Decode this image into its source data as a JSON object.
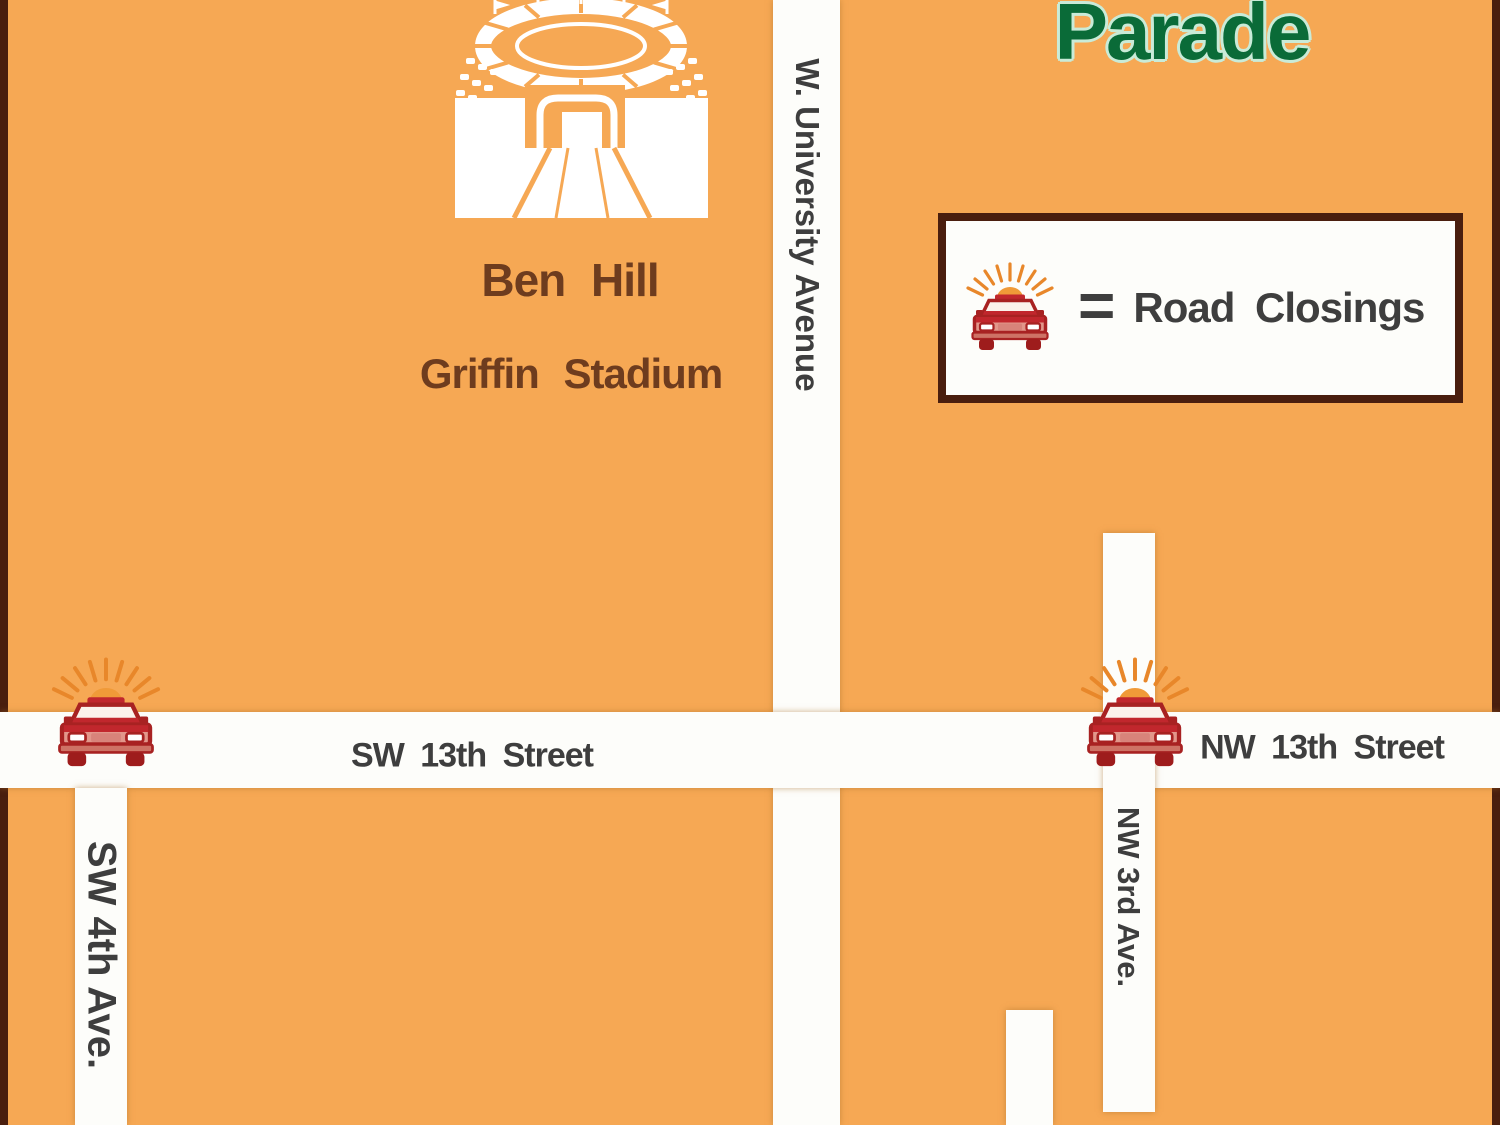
{
  "title": {
    "text": "Parade"
  },
  "stadium": {
    "label_line1": "Ben Hill",
    "label_line2": "Griffin Stadium"
  },
  "legend": {
    "icon": "police-car-icon",
    "equals": "=",
    "label": "Road Closings"
  },
  "roads": {
    "w_university": "W. University Avenue",
    "sw_13th": "SW 13th Street",
    "nw_13th": "NW 13th Street",
    "sw_4th": "SW 4th Ave.",
    "nw_3rd": "NW 3rd Ave."
  },
  "closures": [
    {
      "id": "sw-13th-at-sw-4th"
    },
    {
      "id": "nw-13th-at-nw-3rd"
    }
  ],
  "colors": {
    "bg_orange": "#F6A854",
    "road_white": "#FDFDFA",
    "border_brown": "#4A1E0E",
    "label_dark": "#3E3E3E",
    "stadium_brown": "#6E3C1E",
    "parade_green": "#0A6B38",
    "parade_mint": "#C9EBD8",
    "car_red": "#C1272D",
    "car_dark_red": "#9E1C1C",
    "ray_orange": "#E8872A"
  }
}
